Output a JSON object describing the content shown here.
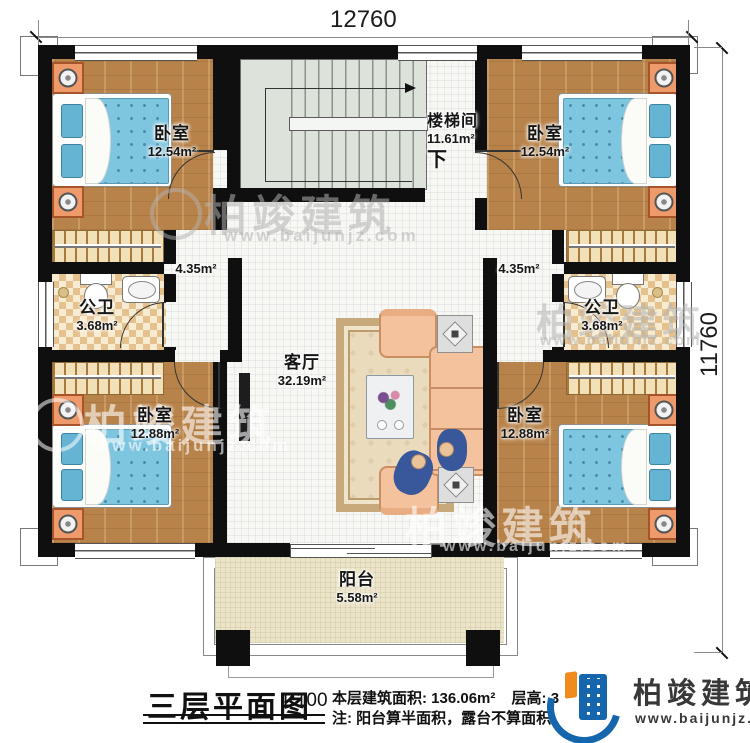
{
  "dimensions": {
    "width": "12760",
    "height": "11760"
  },
  "rooms": {
    "bedroom_tl": {
      "name": "卧室",
      "area": "12.54m²"
    },
    "bedroom_tr": {
      "name": "卧室",
      "area": "12.54m²"
    },
    "bedroom_bl": {
      "name": "卧室",
      "area": "12.88m²"
    },
    "bedroom_br": {
      "name": "卧室",
      "area": "12.88m²"
    },
    "stair": {
      "name": "楼梯间",
      "area": "11.61m²",
      "down": "下"
    },
    "bath_l": {
      "name": "公卫",
      "area": "3.68m²"
    },
    "bath_r": {
      "name": "公卫",
      "area": "3.68m²"
    },
    "hall_l": {
      "area": "4.35m²"
    },
    "hall_r": {
      "area": "4.35m²"
    },
    "living": {
      "name": "客厅",
      "area": "32.19m²"
    },
    "balcony": {
      "name": "阳台",
      "area": "5.58m²"
    }
  },
  "title_block": {
    "title": "三层平面图",
    "scale": "1:100",
    "area_info": "本层建筑面积: 136.06m²",
    "height_info": "层高: 3",
    "note": "注: 阳台算半面积，露台不算面积"
  },
  "brand": {
    "name": "柏竣建筑",
    "website": "www.baijunjz.com"
  },
  "watermark": {
    "text": "柏竣建筑",
    "url": "www.baijunjz.com"
  },
  "colors": {
    "wall": "#0f0f0f",
    "wood_floor": "#b8834a",
    "tile_floor": "#f7f7f4",
    "bath_tile": "#e5c18d",
    "stair_floor": "#dde3da",
    "balcony_floor": "#ece4c6",
    "bed_blue": "#7ec6e0",
    "sofa": "#f5c29e",
    "brand_blue": "#1566ac",
    "brand_orange": "#f08c1e"
  }
}
